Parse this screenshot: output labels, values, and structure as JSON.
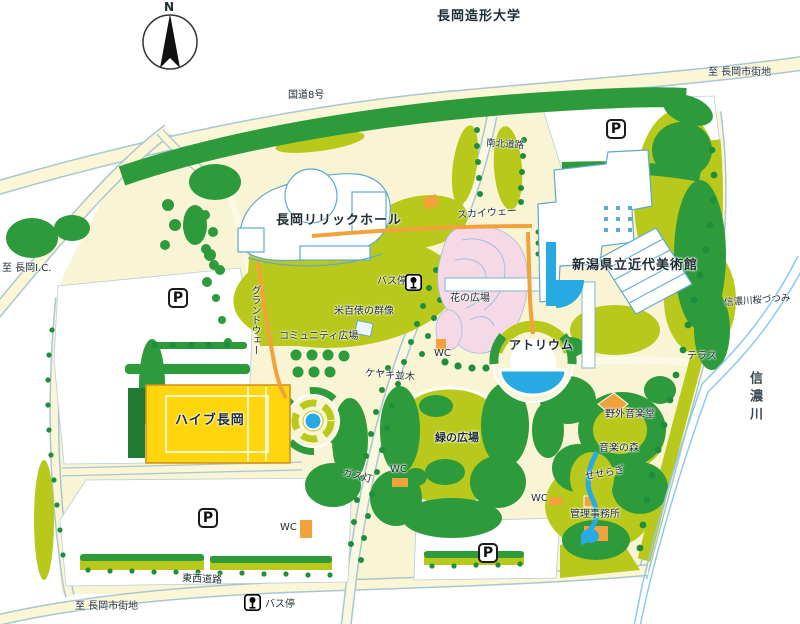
{
  "labels": {
    "north": "N",
    "university": "長岡造形大学",
    "route8": "国道8号",
    "to_city_top": "至 長岡市街地",
    "north_south_road": "南北道路",
    "lyric_hall": "長岡リリックホール",
    "skyway": "スカイウェー",
    "museum": "新潟県立近代美術館",
    "to_nagaoka_ic": "至 長岡I.C.",
    "bus_stop_mid": "バス停",
    "flower_plaza": "花の広場",
    "grandway": "グランドウェー",
    "rice_bales_statues": "米百俵の群像",
    "community_plaza": "コミュニティ広場",
    "wc_flower": "WC",
    "atrium": "アトリウム",
    "sakura_levee": "信濃川桜づつみ",
    "terrace": "テラス",
    "shinano_river": "信濃川",
    "zelkova_row": "ケヤキ並木",
    "hive_nagaoka": "ハイブ長岡",
    "green_plaza": "緑の広場",
    "outdoor_music_hall": "野外音楽堂",
    "music_forest": "音楽の森",
    "seseragi": "せせらぎ",
    "gas_lamp": "ガス灯",
    "wc_green_west": "WC",
    "wc_music": "WC",
    "admin_office": "管理事務所",
    "wc_south": "WC",
    "east_west_road": "東西道路",
    "to_city_bottom": "至 長岡市街地",
    "bus_stop_bottom": "バス停",
    "parking": "P"
  },
  "colors": {
    "park_ground": "#f8f4d4",
    "lawn_green": "#b9c91b",
    "tree_green": "#2d9a3c",
    "building_outline_blue": "#5fa9cf",
    "water_blue": "#27a9e1",
    "flower_pink": "#f5d9e6",
    "hive_yellow": "#ffd60d",
    "path_orange": "#f2a23b"
  }
}
